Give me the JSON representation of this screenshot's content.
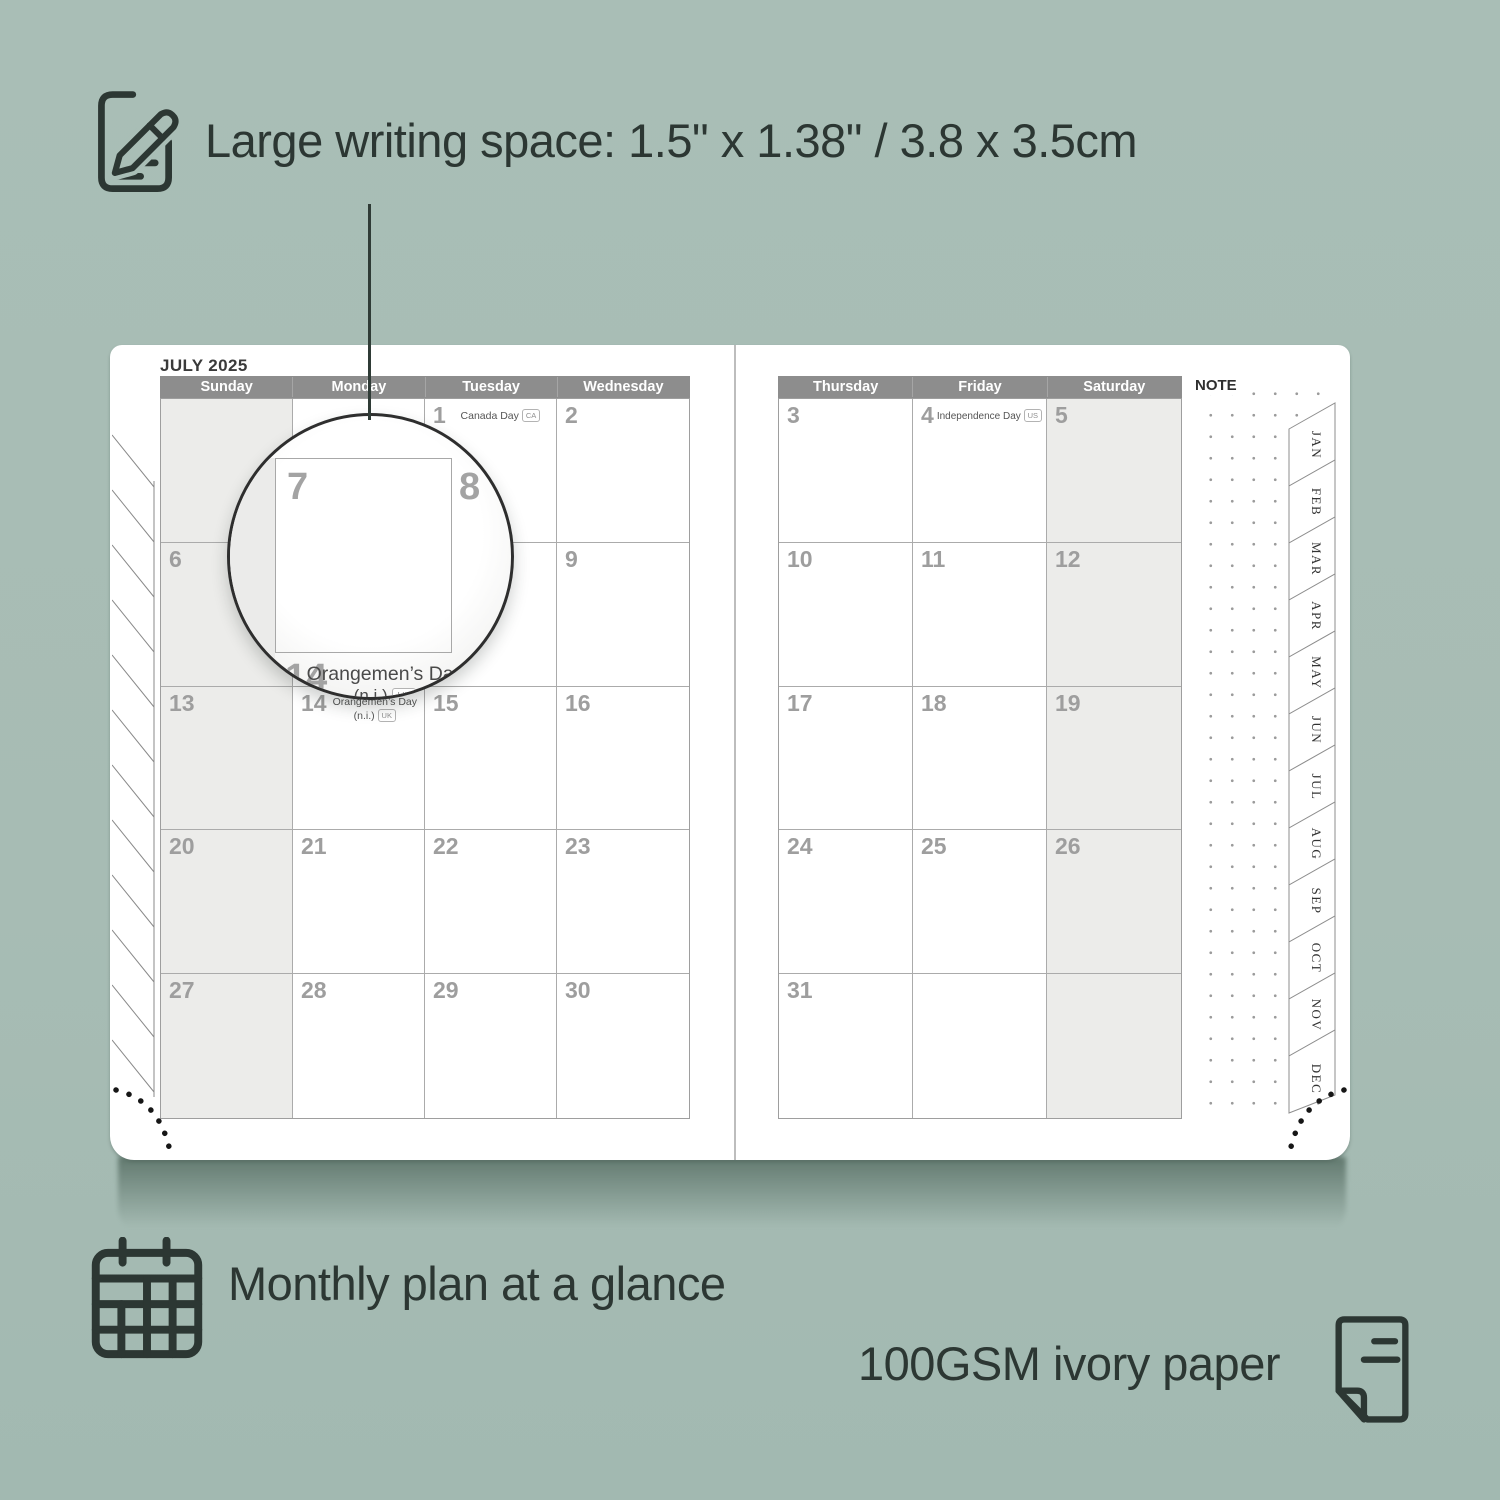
{
  "features": {
    "writing_space": "Large writing space: 1.5\" x 1.38\" / 3.8 x 3.5cm",
    "monthly_plan": "Monthly plan at a glance",
    "paper": "100GSM ivory paper"
  },
  "colors": {
    "background": "#a7bcb4",
    "ink": "#2c3733",
    "header_bar": "#8d8d8d",
    "weekend_shade": "#ececea",
    "day_number": "#9e9e9e"
  },
  "calendar": {
    "title": "JULY 2025",
    "note_label": "NOTE",
    "weekdays_left": [
      "Sunday",
      "Monday",
      "Tuesday",
      "Wednesday"
    ],
    "weekdays_right": [
      "Thursday",
      "Friday",
      "Saturday"
    ],
    "tabs": [
      "JAN",
      "FEB",
      "MAR",
      "APR",
      "MAY",
      "JUN",
      "JUL",
      "AUG",
      "SEP",
      "OCT",
      "NOV",
      "DEC"
    ],
    "left_days": [
      "",
      "",
      "1",
      "2",
      "6",
      "7",
      "8",
      "9",
      "13",
      "14",
      "15",
      "16",
      "20",
      "21",
      "22",
      "23",
      "27",
      "28",
      "29",
      "30"
    ],
    "right_days": [
      "3",
      "4",
      "5",
      "10",
      "11",
      "12",
      "17",
      "18",
      "19",
      "24",
      "25",
      "26",
      "31",
      "",
      ""
    ],
    "holidays": {
      "canada": {
        "label": "Canada Day",
        "badge": "CA"
      },
      "us": {
        "label": "Independence Day",
        "badge": "US"
      },
      "uk": {
        "label": "Orangemen’s Day",
        "label2": "(n.i.)",
        "badge": "UK"
      }
    },
    "magnifier": {
      "day_a": "7",
      "day_b": "8",
      "day_c": "14"
    }
  }
}
